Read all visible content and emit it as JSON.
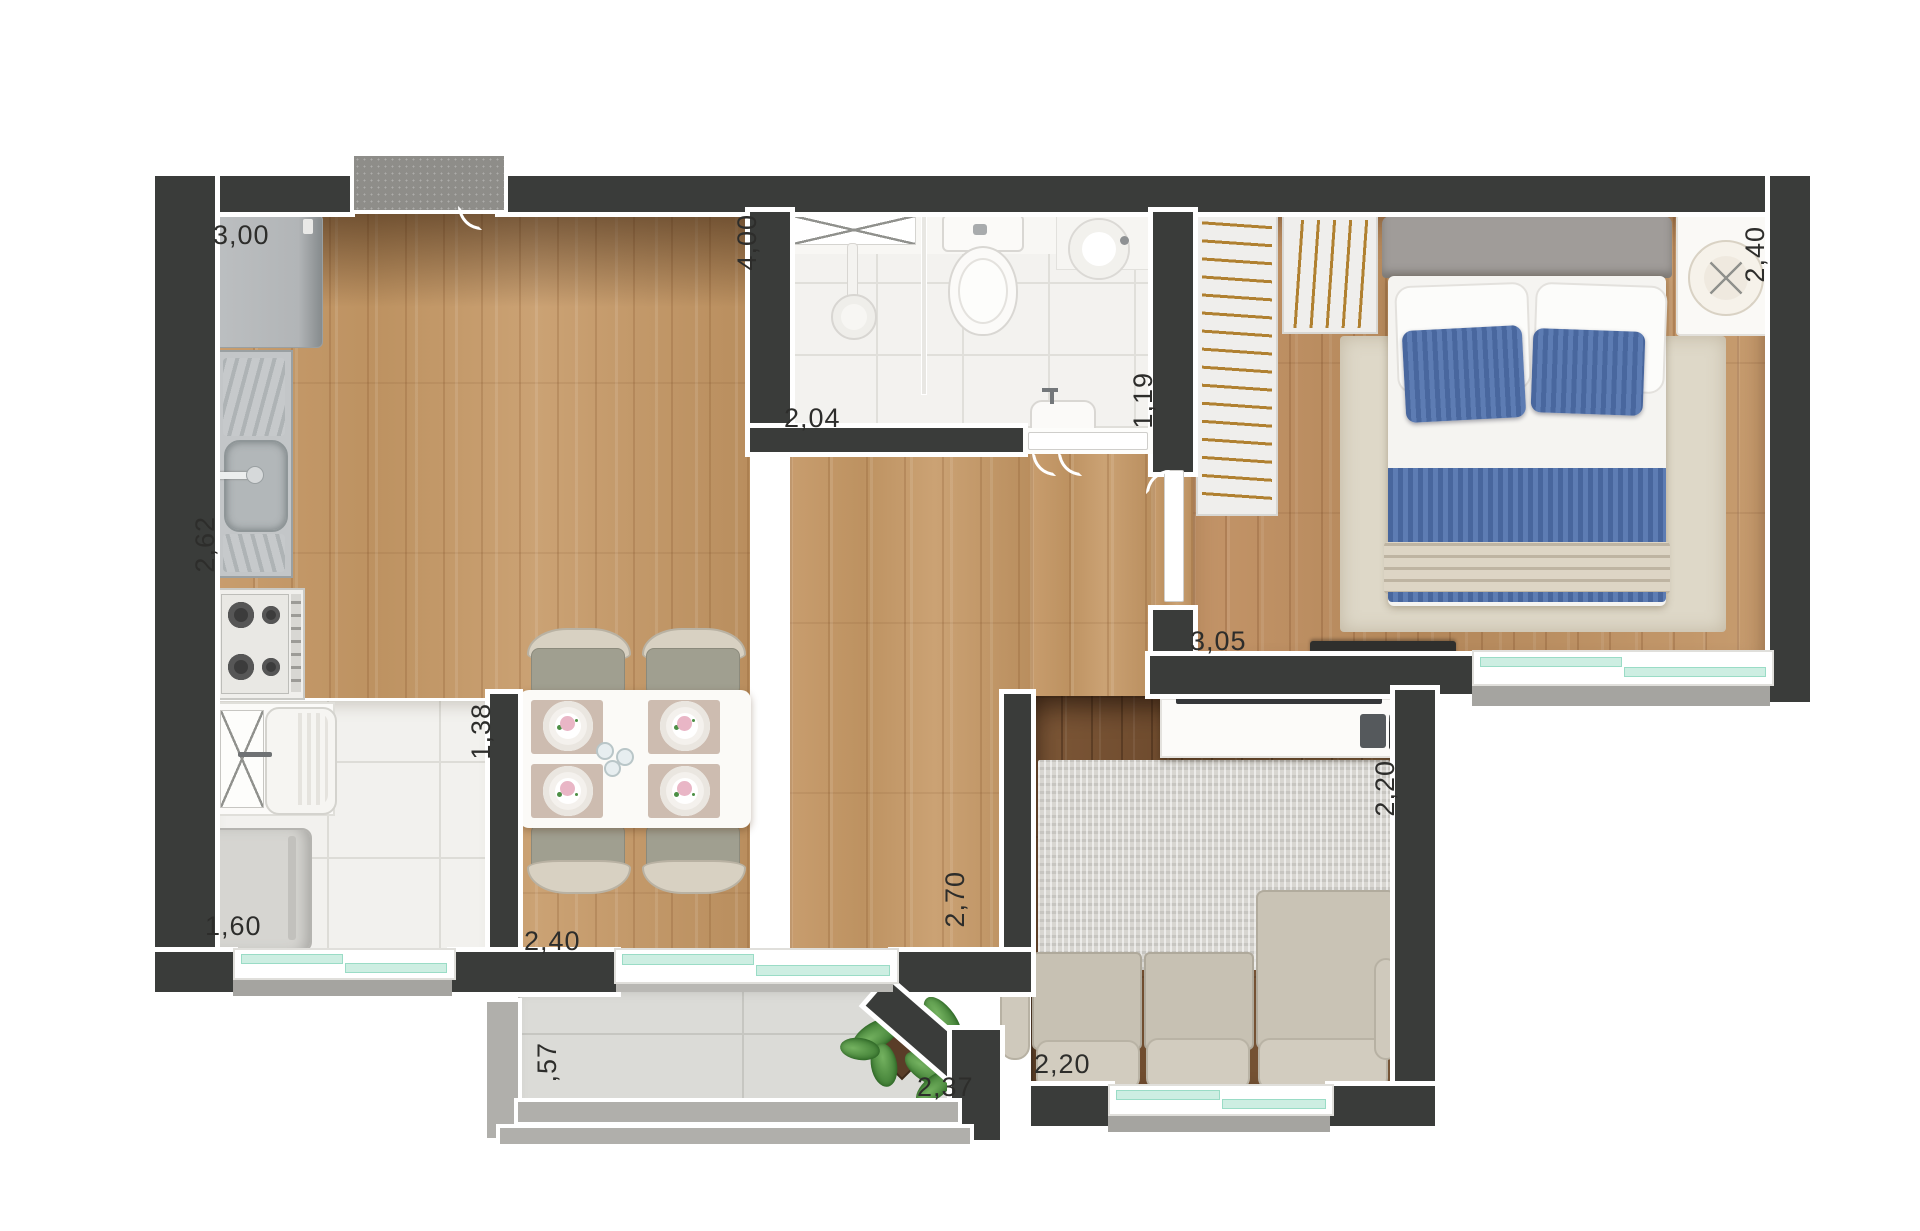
{
  "title": "apartment-floor-plan",
  "dims": {
    "kitchen_top": "3,00",
    "living_height": "4,00",
    "bathroom_width": "2,04",
    "bathroom_height": "1,19",
    "bedroom_nightstand_side": "2,40",
    "kitchen_counter_side": "2,62",
    "bedroom_width": "3,05",
    "laundry_height": "1,38",
    "tv_wall_height": "2,20",
    "dining_height": "2,70",
    "laundry_width": "1,60",
    "dining_width": "2,40",
    "balcony_width": "2,37",
    "sofa_width": "2,20",
    "balcony_height": ",57"
  },
  "fixtures": [
    "fridge",
    "kitchen-sink",
    "stove",
    "laundry-tank",
    "washing-machine",
    "dining-table",
    "dining-chairs",
    "sliding-door",
    "entry-doormat",
    "shower",
    "shower-glass",
    "toilet",
    "round-basin",
    "wall-basin",
    "wardrobe",
    "double-bed",
    "nightstand-lamp",
    "bedroom-tv",
    "tv-console",
    "tv",
    "remote-control",
    "sofa",
    "rug",
    "balcony-plant"
  ],
  "colors": {
    "wall": "#3a3c3a",
    "trim": "#ffffff",
    "wood_light": "#c59a6a",
    "wood_dark": "#7a5536",
    "tile": "#f2f1ee",
    "glass_teal": "#cdeee2",
    "bed_blue": "#5272a8",
    "sofa_beige": "#c9c3b5",
    "hanger_gold": "#b08030",
    "label_text": "#2d2d2b"
  }
}
